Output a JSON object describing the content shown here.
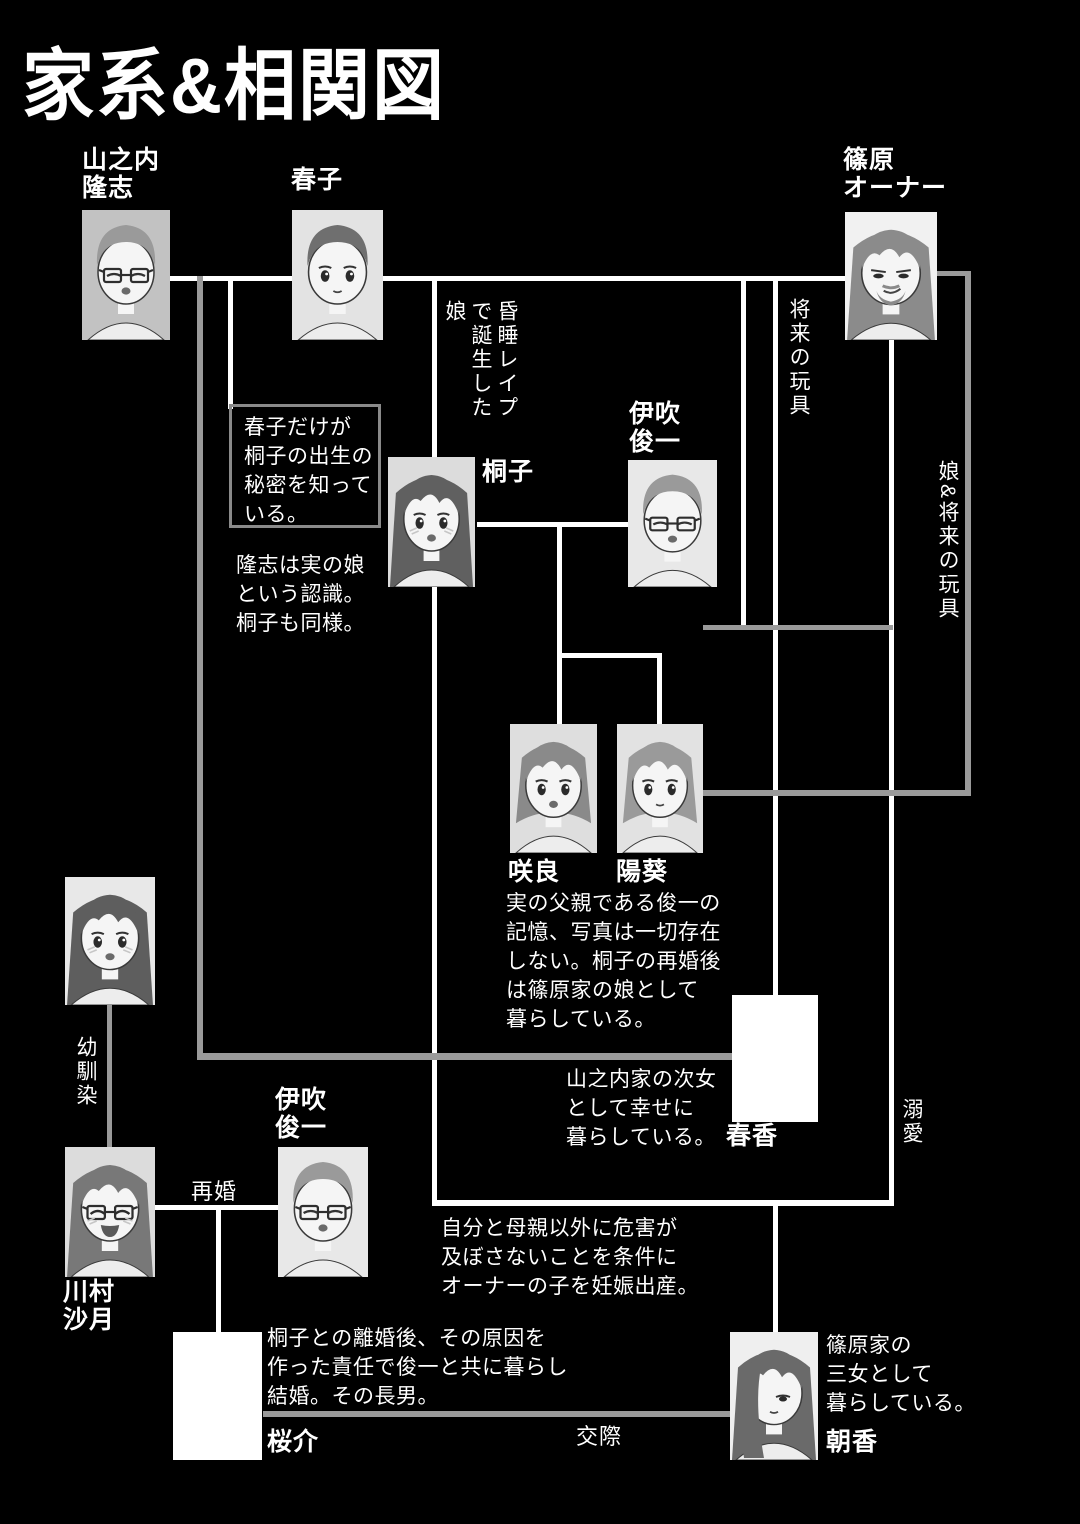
{
  "title": "家系&相関図",
  "people": {
    "takashi": {
      "label": "山之内\n隆志"
    },
    "haruko": {
      "label": "春子"
    },
    "owner": {
      "label": "篠原\nオーナー"
    },
    "kiriko": {
      "label": "桐子"
    },
    "shunichi": {
      "label": "伊吹\n俊一"
    },
    "sakura": {
      "label": "咲良"
    },
    "himari": {
      "label": "陽葵"
    },
    "haruka": {
      "label": "春香"
    },
    "friend": {
      "label": ""
    },
    "satsuki": {
      "label": "川村\n沙月"
    },
    "shunichi2": {
      "label": "伊吹\n俊一"
    },
    "ousuke": {
      "label": "桜介"
    },
    "asaka": {
      "label": "朝香"
    }
  },
  "relationship_labels": {
    "remarriage": "再婚",
    "dating": "交際",
    "childhood_friend": "幼馴染",
    "doting": "溺愛",
    "future_toy": "将来の玩具",
    "daughter_and_future_toy": "娘&将来の玩具",
    "comatose_rape_daughter": "昏睡レイプで誕生した娘"
  },
  "notes": {
    "haruko_secret": "春子だけが\n桐子の出生の\n秘密を知って\nいる。",
    "takashi_recognition": "隆志は実の娘\nという認識。\n桐子も同様。",
    "twins_note": "実の父親である俊一の\n記憶、写真は一切存在\nしない。桐子の再婚後\nは篠原家の娘として\n暮らしている。",
    "haruka_note": "山之内家の次女\nとして幸せに\n暮らしている。",
    "kiriko_deal": "自分と母親以外に危害が\n及ぼさないことを条件に\nオーナーの子を妊娠出産。",
    "ousuke_note": "桐子との離婚後、その原因を\n作った責任で俊一と共に暮らし\n結婚。その長男。",
    "asaka_note": "篠原家の\n三女として\n暮らしている。"
  },
  "colors": {
    "background": "#000000",
    "line_white": "#ffffff",
    "line_gray": "#9a9a9a",
    "text": "#ffffff"
  }
}
